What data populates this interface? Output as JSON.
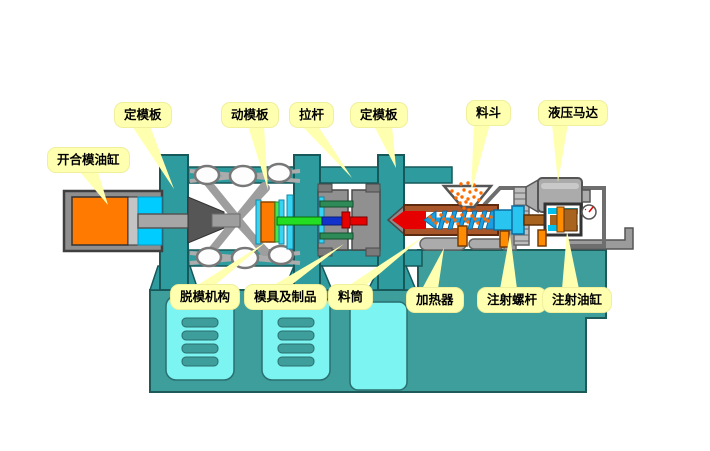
{
  "diagram": {
    "title": "注塑机结构示意图",
    "background_color": "#ffffff",
    "callouts": {
      "clamp_cylinder": "开合模油缸",
      "rear_platen": "定模板",
      "moving_platen": "动模板",
      "tie_bar": "拉杆",
      "fixed_platen": "定模板",
      "hopper": "料斗",
      "hydraulic_motor": "液压马达",
      "ejector_mechanism": "脱模机构",
      "mold_and_product": "模具及制品",
      "barrel": "料筒",
      "heater": "加热器",
      "injection_screw": "注射螺杆",
      "injection_cylinder": "注射油缸"
    },
    "colors": {
      "machine_teal": "#2E9C9F",
      "base_teal": "#3E9E9B",
      "panel_cyan": "#7CF4F1",
      "callout_yellow": "#FFFFB0",
      "oil_orange": "#FF7A00",
      "chamber_cyan": "#00CCFF",
      "melt_red": "#E60000",
      "ejector_green": "#22DD22",
      "barrel_brown": "#A8562A",
      "screw_blue": "#1B9DE0",
      "pellet_orange": "#FF6A00",
      "metal_gray": "#9B9B9B"
    }
  }
}
